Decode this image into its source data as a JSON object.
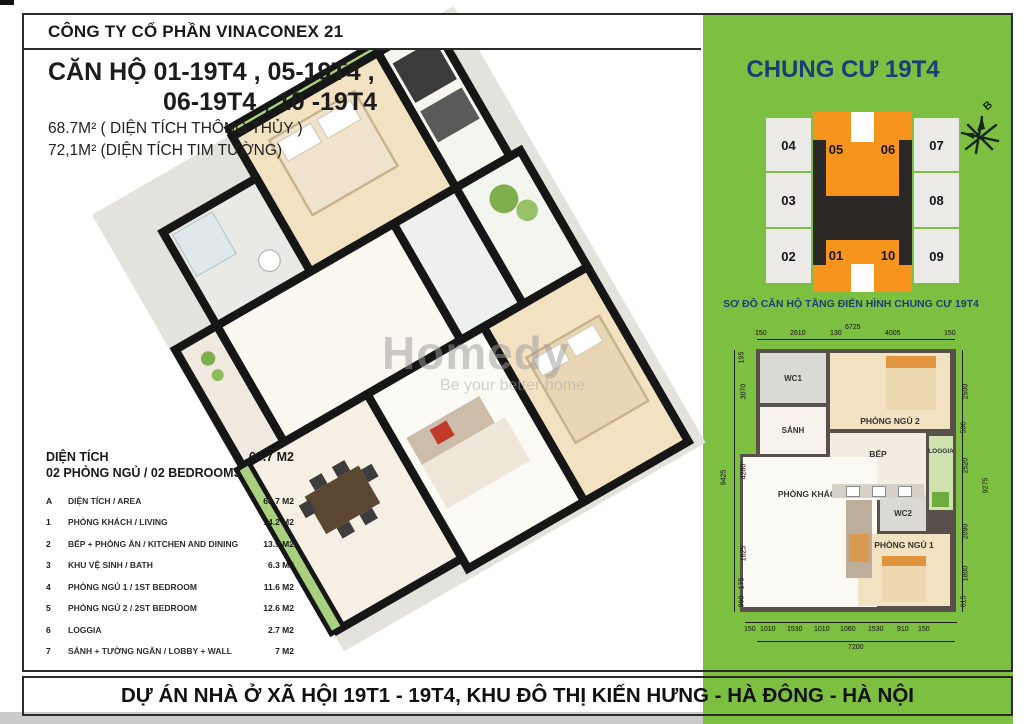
{
  "header": {
    "company": "CÔNG TY CỔ PHẦN VINACONEX 21"
  },
  "footer": {
    "project": "DỰ ÁN NHÀ Ở XÃ HỘI 19T1 - 19T4, KHU ĐÔ THỊ KIẾN HƯNG - HÀ ĐÔNG - HÀ NỘI"
  },
  "apartment_info": {
    "title_line1": "CĂN HỘ  01-19T4 , 05-19T4 ,",
    "title_line2": "06-19T4 , 10 -19T4",
    "area_line1": "68.7M² ( DIỆN TÍCH THÔNG THỦY )",
    "area_line2": "72,1M² (DIỆN TÍCH TIM TƯỜNG)"
  },
  "watermark": {
    "name": "Homedy",
    "tagline": "Be your better home"
  },
  "spec_table": {
    "header_left": "DIỆN TÍCH",
    "header_value": "68.7 M2",
    "header_sub": "02 PHÒNG NGỦ / 02 BEDROOMS",
    "rows": [
      {
        "no": "A",
        "label": "DIỆN TÍCH / AREA",
        "value": "68.7 M2"
      },
      {
        "no": "1",
        "label": "PHÒNG KHÁCH / LIVING",
        "value": "14.2 M2"
      },
      {
        "no": "2",
        "label": "BẾP + PHÒNG ĂN / KITCHEN AND DINING",
        "value": "13.9 M2"
      },
      {
        "no": "3",
        "label": "KHU VỆ SINH / BATH",
        "value": "6.3 M2"
      },
      {
        "no": "4",
        "label": "PHÒNG NGỦ 1 / 1ST BEDROOM",
        "value": "11.6 M2"
      },
      {
        "no": "5",
        "label": "PHÒNG NGỦ 2 / 2ST BEDROOM",
        "value": "12.6 M2"
      },
      {
        "no": "6",
        "label": "LOGGIA",
        "value": "2.7 M2"
      },
      {
        "no": "7",
        "label": "SẢNH + TƯỜNG NGĂN / LOBBY + WALL",
        "value": "7 M2"
      }
    ]
  },
  "tower_panel": {
    "title": "CHUNG CƯ 19T4",
    "compass_label": "B",
    "diagram_caption": "SƠ ĐỒ CĂN HỘ TẦNG ĐIỂN HÌNH CHUNG CƯ 19T4",
    "units": {
      "left": [
        "04",
        "03",
        "02"
      ],
      "right": [
        "07",
        "08",
        "09"
      ],
      "top_orange": [
        "05",
        "06"
      ],
      "bottom_orange": [
        "01",
        "10"
      ]
    },
    "highlight_color": "#F7941E"
  },
  "plan2d": {
    "rooms": {
      "wc1": "WC1",
      "hall": "SẢNH",
      "bedroom2": "PHÒNG NGỦ 2",
      "kitchen": "BẾP",
      "living": "PHÒNG KHÁCH",
      "wc2": "WC2",
      "bedroom1": "PHÒNG NGỦ 1",
      "loggia": "LOGGIA"
    },
    "dims": {
      "top_total": "6725",
      "top": [
        "150",
        "2610",
        "130",
        "4005",
        "150"
      ],
      "left_total": "9425",
      "left": [
        "195",
        "3070",
        "4280",
        "1625",
        "175",
        "960"
      ],
      "right_total": "9275",
      "right": [
        "2500",
        "500",
        "2520",
        "2090",
        "1800",
        "615"
      ],
      "bottom_total": "7200",
      "bottom": [
        "150",
        "1010",
        "1530",
        "1010",
        "1060",
        "1530",
        "910",
        "150"
      ]
    }
  },
  "colors": {
    "panel_green": "#7cbf41",
    "navy_text": "#1d3d77",
    "highlight_orange": "#F7941E",
    "unit_gray": "#ECEAE6",
    "core_black": "#2B2825",
    "wall": "#57504B"
  }
}
